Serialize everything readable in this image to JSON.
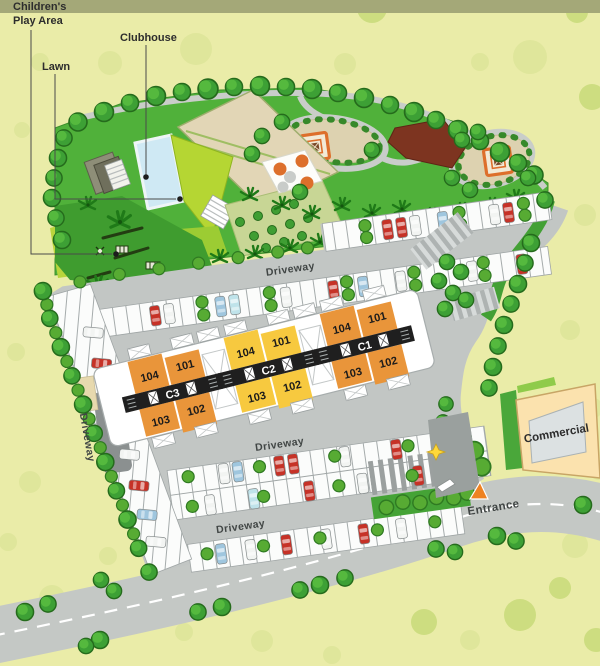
{
  "title": "Residential Site Plan",
  "colors": {
    "background": "#eaeca8",
    "top_band": "#a4a878",
    "garden_green": "#50b13a",
    "play_area_green": "#3f9c2f",
    "lawn_lime": "#b5d633",
    "pool_blue": "#cfe9f4",
    "driveway_gray": "#c2c6c4",
    "building_orange": "#e9953a",
    "building_yellow": "#f7c93f",
    "commercial_cream": "#fbe2ae",
    "entrance_orange": "#ee8222"
  },
  "legend": {
    "childrens_play_area_line1": "Children's",
    "childrens_play_area_line2": "Play Area",
    "clubhouse": "Clubhouse",
    "lawn": "Lawn"
  },
  "labels": {
    "driveway_top": "Driveway",
    "driveway_left": "Driveway",
    "driveway_middle": "Driveway",
    "driveway_bottom": "Driveway",
    "entrance": "Entrance",
    "commercial": "Commercial"
  },
  "buildings": [
    {
      "name": "C1",
      "units": [
        "104",
        "101",
        "103",
        "102"
      ]
    },
    {
      "name": "C2",
      "units": [
        "104",
        "101",
        "103",
        "102"
      ]
    },
    {
      "name": "C3",
      "units": [
        "104",
        "101",
        "103",
        "102"
      ]
    }
  ]
}
